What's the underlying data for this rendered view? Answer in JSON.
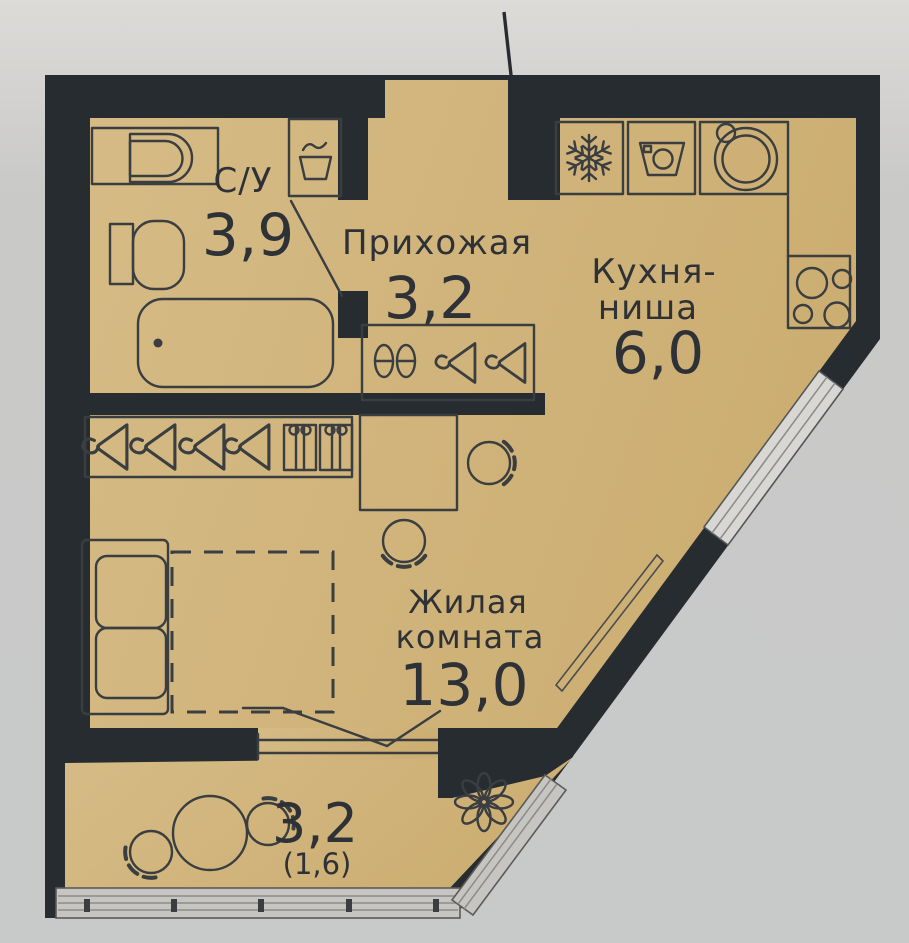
{
  "plan_title": "studio-apartment-floor-plan",
  "rooms": {
    "bathroom": {
      "name": "С/У",
      "area": "3,9"
    },
    "hallway": {
      "name": "Прихожая",
      "area": "3,2"
    },
    "kitchen": {
      "name_line1": "Кухня-",
      "name_line2": "ниша",
      "area": "6,0"
    },
    "living": {
      "name_line1": "Жилая",
      "name_line2": "комната",
      "area": "13,0"
    },
    "balcony": {
      "area": "3,2",
      "area_coefficient": "(1,6)"
    }
  },
  "palette": {
    "wall": "#272c30",
    "floor": "#d2b67e",
    "outside_top": "#dcdbd8",
    "outside": "#c9c9c8",
    "furniture_line": "#3a3e40",
    "window_fill": "#d8d7d3",
    "railing_fill": "#c6c5c2",
    "text": "#2e3236"
  },
  "icons": {
    "bathroom": [
      "sink-counter-icon",
      "toilet-icon",
      "bathtub-icon",
      "laundry-basin-icon",
      "door-swing-icon"
    ],
    "hallway": [
      "shoe-shelf-icon",
      "hanger-icon",
      "closet-icon"
    ],
    "wardrobe": [
      "hanger-icon",
      "storage-box-icon"
    ],
    "kitchen": [
      "fridge-snowflake-icon",
      "washing-machine-icon",
      "round-sink-icon",
      "stove-burners-icon",
      "counter-icon"
    ],
    "living": [
      "sofa-icon",
      "desk-icon",
      "chair-icon",
      "bed-zone-dashed-icon",
      "radiator-icon"
    ],
    "balcony": [
      "round-table-icon",
      "chair-icon",
      "plant-icon",
      "railing-icon",
      "window-sill-icon"
    ],
    "exterior": [
      "entrance-leader-line",
      "diagonal-window-icon"
    ]
  }
}
